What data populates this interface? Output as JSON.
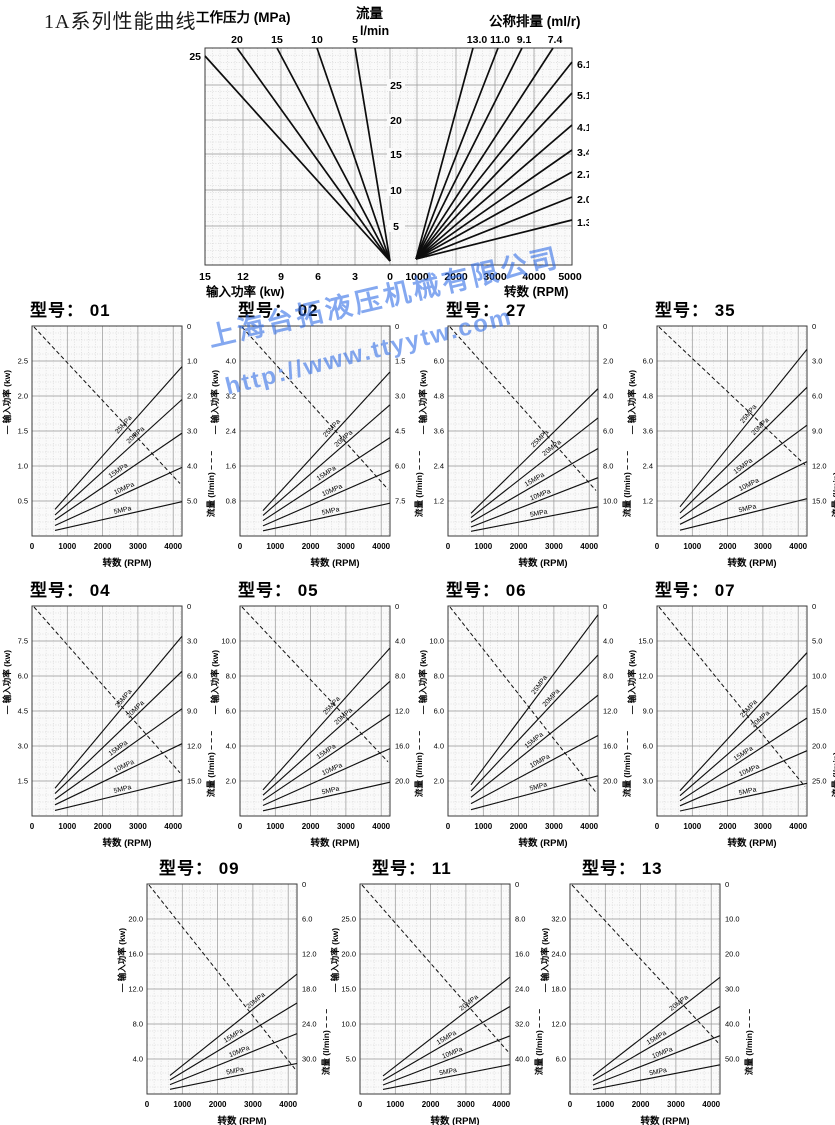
{
  "page_title": "1A系列性能曲线",
  "watermark": {
    "line1": "上海台拓液压机械有限公司",
    "line2": "http://www.ttyytw.com",
    "color": "#3272e0"
  },
  "main_chart": {
    "axis_title_pressure": "工作压力 (MPa)",
    "axis_title_flow": "流量",
    "axis_title_flow_unit": "l/min",
    "axis_title_displacement": "公称排量 (ml/r)",
    "pressure_top_ticks": [
      "20",
      "15",
      "10",
      "5"
    ],
    "pressure_left_tick": "25",
    "displacement_top_ticks": [
      "13.0",
      "11.0",
      "9.1",
      "7.4"
    ],
    "displacement_right_ticks": [
      "6.1",
      "5.1",
      "4.1",
      "3.4",
      "2.7",
      "2.0",
      "1.3"
    ],
    "flow_center_ticks": [
      "25",
      "20",
      "15",
      "10",
      "5"
    ],
    "power_bottom_ticks": [
      "15",
      "12",
      "9",
      "6",
      "3",
      "0"
    ],
    "rpm_bottom_ticks": [
      "1000",
      "2000",
      "3000",
      "4000",
      "5000"
    ],
    "caption_left": "输入功率 (kw)",
    "caption_right": "转数 (RPM)"
  },
  "small_chart_common": {
    "title_prefix": "型号：",
    "x_ticks": [
      "0",
      "1000",
      "2000",
      "3000",
      "4000"
    ],
    "x_caption": "转数 (RPM)",
    "y_left_label": "— 输入功率 (kw)",
    "y_right_label": "流量  (l/min)",
    "dashed_legend": "– – –"
  },
  "chart_data": {
    "main": {
      "type": "line",
      "title": "1A系列性能曲线",
      "left_half_x_axis": {
        "label": "输入功率 (kw)",
        "range": [
          15,
          0
        ]
      },
      "right_half_x_axis": {
        "label": "转数 (RPM)",
        "range": [
          0,
          5000
        ]
      },
      "center_y_axis": {
        "label": "流量 l/min",
        "range": [
          0,
          28
        ],
        "ticks": [
          25,
          20,
          15,
          10,
          5
        ]
      },
      "pressure_lines_MPa": [
        {
          "label": "25",
          "kw_at_28_lmin": 15.0,
          "kw_at_0_lmin": 0
        },
        {
          "label": "20",
          "kw_at_28_lmin": 12.3,
          "kw_at_0_lmin": 0
        },
        {
          "label": "15",
          "kw_at_28_lmin": 9.2,
          "kw_at_0_lmin": 0
        },
        {
          "label": "10",
          "kw_at_28_lmin": 6.1,
          "kw_at_0_lmin": 0
        },
        {
          "label": "5",
          "kw_at_28_lmin": 2.8,
          "kw_at_0_lmin": 0
        }
      ],
      "displacement_lines_ml_r": [
        {
          "label": "13.0",
          "lmin_per_1000rpm": 13.0
        },
        {
          "label": "11.0",
          "lmin_per_1000rpm": 11.0
        },
        {
          "label": "9.1",
          "lmin_per_1000rpm": 9.1
        },
        {
          "label": "7.4",
          "lmin_per_1000rpm": 7.4
        },
        {
          "label": "6.1",
          "lmin_per_1000rpm": 6.1
        },
        {
          "label": "5.1",
          "lmin_per_1000rpm": 5.1
        },
        {
          "label": "4.1",
          "lmin_per_1000rpm": 4.1
        },
        {
          "label": "3.4",
          "lmin_per_1000rpm": 3.4
        },
        {
          "label": "2.7",
          "lmin_per_1000rpm": 2.7
        },
        {
          "label": "2.0",
          "lmin_per_1000rpm": 2.0
        },
        {
          "label": "1.3",
          "lmin_per_1000rpm": 1.3
        }
      ]
    },
    "models": [
      {
        "model": "01",
        "type": "line",
        "x_axis": {
          "label": "转数 (RPM)",
          "range": [
            0,
            4250
          ],
          "ticks": [
            0,
            1000,
            2000,
            3000,
            4000
          ]
        },
        "left_ticks": [
          "0.5",
          "1.0",
          "1.5",
          "2.0",
          "2.5"
        ],
        "left_axis_max_kw": 3.0,
        "right_ticks": [
          "0",
          "1.0",
          "2.0",
          "3.0",
          "4.0",
          "5.0"
        ],
        "right_axis_max_lmin": 6.0,
        "solid_lines": [
          {
            "label": "25MPa",
            "kw_at_700rpm": 0.38,
            "kw_at_4100rpm": 2.42
          },
          {
            "label": "20MPa",
            "kw_at_700rpm": 0.3,
            "kw_at_4100rpm": 1.95
          },
          {
            "label": "15MPa",
            "kw_at_700rpm": 0.23,
            "kw_at_4100rpm": 1.47
          },
          {
            "label": "10MPa",
            "kw_at_700rpm": 0.15,
            "kw_at_4100rpm": 0.98
          },
          {
            "label": "5MPa",
            "kw_at_700rpm": 0.08,
            "kw_at_4100rpm": 0.49
          }
        ],
        "dashed_flow_line": {
          "lmin_at_0rpm": 0,
          "lmin_at_4100rpm": 4.5
        }
      },
      {
        "model": "02",
        "type": "line",
        "x_axis": {
          "label": "转数 (RPM)",
          "range": [
            0,
            4250
          ],
          "ticks": [
            0,
            1000,
            2000,
            3000,
            4000
          ]
        },
        "left_ticks": [
          "0.8",
          "1.6",
          "2.4",
          "3.2",
          "4.0"
        ],
        "left_axis_max_kw": 4.8,
        "right_ticks": [
          "0",
          "1.5",
          "3.0",
          "4.5",
          "6.0",
          "7.5"
        ],
        "right_axis_max_lmin": 9.0,
        "solid_lines": [
          {
            "label": "25MPa",
            "kw_at_700rpm": 0.58,
            "kw_at_4100rpm": 3.75
          },
          {
            "label": "20MPa",
            "kw_at_700rpm": 0.47,
            "kw_at_4100rpm": 3.0
          },
          {
            "label": "15MPa",
            "kw_at_700rpm": 0.35,
            "kw_at_4100rpm": 2.25
          },
          {
            "label": "10MPa",
            "kw_at_700rpm": 0.23,
            "kw_at_4100rpm": 1.5
          },
          {
            "label": "5MPa",
            "kw_at_700rpm": 0.12,
            "kw_at_4100rpm": 0.75
          }
        ],
        "dashed_flow_line": {
          "lmin_at_0rpm": 0,
          "lmin_at_4100rpm": 7.0
        }
      },
      {
        "model": "27",
        "type": "line",
        "x_axis": {
          "label": "转数 (RPM)",
          "range": [
            0,
            4250
          ],
          "ticks": [
            0,
            1000,
            2000,
            3000,
            4000
          ]
        },
        "left_ticks": [
          "1.2",
          "2.4",
          "3.6",
          "4.8",
          "6.0"
        ],
        "left_axis_max_kw": 7.2,
        "right_ticks": [
          "0",
          "2.0",
          "4.0",
          "6.0",
          "8.0",
          "10.0"
        ],
        "right_axis_max_lmin": 12.0,
        "solid_lines": [
          {
            "label": "25MPa",
            "kw_at_700rpm": 0.78,
            "kw_at_4100rpm": 5.05
          },
          {
            "label": "20MPa",
            "kw_at_700rpm": 0.63,
            "kw_at_4100rpm": 4.05
          },
          {
            "label": "15MPa",
            "kw_at_700rpm": 0.47,
            "kw_at_4100rpm": 3.0
          },
          {
            "label": "10MPa",
            "kw_at_700rpm": 0.31,
            "kw_at_4100rpm": 2.0
          },
          {
            "label": "5MPa",
            "kw_at_700rpm": 0.16,
            "kw_at_4100rpm": 1.0
          }
        ],
        "dashed_flow_line": {
          "lmin_at_0rpm": 0,
          "lmin_at_4100rpm": 9.4
        }
      },
      {
        "model": "35",
        "type": "line",
        "x_axis": {
          "label": "转数 (RPM)",
          "range": [
            0,
            4250
          ],
          "ticks": [
            0,
            1000,
            2000,
            3000,
            4000
          ]
        },
        "left_ticks": [
          "1.2",
          "2.4",
          "3.6",
          "4.8",
          "6.0"
        ],
        "left_axis_max_kw": 7.2,
        "right_ticks": [
          "0",
          "3.0",
          "6.0",
          "9.0",
          "12.0",
          "15.0"
        ],
        "right_axis_max_lmin": 18.0,
        "solid_lines": [
          {
            "label": "25MPa",
            "kw_at_700rpm": 1.0,
            "kw_at_4100rpm": 6.4
          },
          {
            "label": "20MPa",
            "kw_at_700rpm": 0.79,
            "kw_at_4100rpm": 5.1
          },
          {
            "label": "15MPa",
            "kw_at_700rpm": 0.59,
            "kw_at_4100rpm": 3.8
          },
          {
            "label": "10MPa",
            "kw_at_700rpm": 0.4,
            "kw_at_4100rpm": 2.55
          },
          {
            "label": "5MPa",
            "kw_at_700rpm": 0.2,
            "kw_at_4100rpm": 1.28
          }
        ],
        "dashed_flow_line": {
          "lmin_at_0rpm": 0,
          "lmin_at_4100rpm": 11.9
        }
      },
      {
        "model": "04",
        "type": "line",
        "x_axis": {
          "label": "转数 (RPM)",
          "range": [
            0,
            4250
          ],
          "ticks": [
            0,
            1000,
            2000,
            3000,
            4000
          ]
        },
        "left_ticks": [
          "1.5",
          "3.0",
          "4.5",
          "6.0",
          "7.5"
        ],
        "left_axis_max_kw": 9.0,
        "right_ticks": [
          "0",
          "3.0",
          "6.0",
          "9.0",
          "12.0",
          "15.0"
        ],
        "right_axis_max_lmin": 18.0,
        "solid_lines": [
          {
            "label": "25MPa",
            "kw_at_700rpm": 1.19,
            "kw_at_4100rpm": 7.7
          },
          {
            "label": "20MPa",
            "kw_at_700rpm": 0.96,
            "kw_at_4100rpm": 6.2
          },
          {
            "label": "15MPa",
            "kw_at_700rpm": 0.71,
            "kw_at_4100rpm": 4.6
          },
          {
            "label": "10MPa",
            "kw_at_700rpm": 0.48,
            "kw_at_4100rpm": 3.1
          },
          {
            "label": "5MPa",
            "kw_at_700rpm": 0.24,
            "kw_at_4100rpm": 1.55
          }
        ],
        "dashed_flow_line": {
          "lmin_at_0rpm": 0,
          "lmin_at_4100rpm": 14.3
        }
      },
      {
        "model": "05",
        "type": "line",
        "x_axis": {
          "label": "转数 (RPM)",
          "range": [
            0,
            4250
          ],
          "ticks": [
            0,
            1000,
            2000,
            3000,
            4000
          ]
        },
        "left_ticks": [
          "2.0",
          "4.0",
          "6.0",
          "8.0",
          "10.0"
        ],
        "left_axis_max_kw": 12.0,
        "right_ticks": [
          "0",
          "4.0",
          "8.0",
          "12.0",
          "16.0",
          "20.0"
        ],
        "right_axis_max_lmin": 24.0,
        "solid_lines": [
          {
            "label": "25MPa",
            "kw_at_700rpm": 1.49,
            "kw_at_4100rpm": 9.6
          },
          {
            "label": "20MPa",
            "kw_at_700rpm": 1.19,
            "kw_at_4100rpm": 7.7
          },
          {
            "label": "15MPa",
            "kw_at_700rpm": 0.9,
            "kw_at_4100rpm": 5.8
          },
          {
            "label": "10MPa",
            "kw_at_700rpm": 0.6,
            "kw_at_4100rpm": 3.85
          },
          {
            "label": "5MPa",
            "kw_at_700rpm": 0.3,
            "kw_at_4100rpm": 1.93
          }
        ],
        "dashed_flow_line": {
          "lmin_at_0rpm": 0,
          "lmin_at_4100rpm": 17.8
        }
      },
      {
        "model": "06",
        "type": "line",
        "x_axis": {
          "label": "转数 (RPM)",
          "range": [
            0,
            4250
          ],
          "ticks": [
            0,
            1000,
            2000,
            3000,
            4000
          ]
        },
        "left_ticks": [
          "2.0",
          "4.0",
          "6.0",
          "8.0",
          "10.0"
        ],
        "left_axis_max_kw": 12.0,
        "right_ticks": [
          "0",
          "4.0",
          "8.0",
          "12.0",
          "16.0",
          "20.0"
        ],
        "right_axis_max_lmin": 24.0,
        "solid_lines": [
          {
            "label": "25MPa",
            "kw_at_700rpm": 1.78,
            "kw_at_4100rpm": 11.5
          },
          {
            "label": "20MPa",
            "kw_at_700rpm": 1.43,
            "kw_at_4100rpm": 9.2
          },
          {
            "label": "15MPa",
            "kw_at_700rpm": 1.07,
            "kw_at_4100rpm": 6.9
          },
          {
            "label": "10MPa",
            "kw_at_700rpm": 0.71,
            "kw_at_4100rpm": 4.6
          },
          {
            "label": "5MPa",
            "kw_at_700rpm": 0.36,
            "kw_at_4100rpm": 2.3
          }
        ],
        "dashed_flow_line": {
          "lmin_at_0rpm": 0,
          "lmin_at_4100rpm": 21.3
        }
      },
      {
        "model": "07",
        "type": "line",
        "x_axis": {
          "label": "转数 (RPM)",
          "range": [
            0,
            4250
          ],
          "ticks": [
            0,
            1000,
            2000,
            3000,
            4000
          ]
        },
        "left_ticks": [
          "3.0",
          "6.0",
          "9.0",
          "12.0",
          "15.0"
        ],
        "left_axis_max_kw": 18.0,
        "right_ticks": [
          "0",
          "5.0",
          "10.0",
          "15.0",
          "20.0",
          "25.0"
        ],
        "right_axis_max_lmin": 30.0,
        "solid_lines": [
          {
            "label": "25MPa",
            "kw_at_700rpm": 2.17,
            "kw_at_4100rpm": 14.0
          },
          {
            "label": "20MPa",
            "kw_at_700rpm": 1.74,
            "kw_at_4100rpm": 11.2
          },
          {
            "label": "15MPa",
            "kw_at_700rpm": 1.3,
            "kw_at_4100rpm": 8.4
          },
          {
            "label": "10MPa",
            "kw_at_700rpm": 0.87,
            "kw_at_4100rpm": 5.6
          },
          {
            "label": "5MPa",
            "kw_at_700rpm": 0.43,
            "kw_at_4100rpm": 2.8
          }
        ],
        "dashed_flow_line": {
          "lmin_at_0rpm": 0,
          "lmin_at_4100rpm": 25.8
        }
      },
      {
        "model": "09",
        "type": "line",
        "x_axis": {
          "label": "转数 (RPM)",
          "range": [
            0,
            4250
          ],
          "ticks": [
            0,
            1000,
            2000,
            3000,
            4000
          ]
        },
        "left_ticks": [
          "4.0",
          "8.0",
          "12.0",
          "16.0",
          "20.0"
        ],
        "left_axis_max_kw": 24.0,
        "right_ticks": [
          "0",
          "6.0",
          "12.0",
          "18.0",
          "24.0",
          "30.0"
        ],
        "right_axis_max_lmin": 36.0,
        "solid_lines": [
          {
            "label": "20MPa",
            "kw_at_700rpm": 2.12,
            "kw_at_4100rpm": 13.7
          },
          {
            "label": "15MPa",
            "kw_at_700rpm": 1.61,
            "kw_at_4100rpm": 10.4
          },
          {
            "label": "10MPa",
            "kw_at_700rpm": 1.07,
            "kw_at_4100rpm": 6.9
          },
          {
            "label": "5MPa",
            "kw_at_700rpm": 0.54,
            "kw_at_4100rpm": 3.5
          }
        ],
        "dashed_flow_line": {
          "lmin_at_0rpm": 0,
          "lmin_at_4100rpm": 31.7
        }
      },
      {
        "model": "11",
        "type": "line",
        "x_axis": {
          "label": "转数 (RPM)",
          "range": [
            0,
            4250
          ],
          "ticks": [
            0,
            1000,
            2000,
            3000,
            4000
          ]
        },
        "left_ticks": [
          "5.0",
          "10.0",
          "15.0",
          "20.0",
          "25.0"
        ],
        "left_axis_max_kw": 30.0,
        "right_ticks": [
          "0",
          "8.0",
          "16.0",
          "24.0",
          "32.0",
          "40.0"
        ],
        "right_axis_max_lmin": 48.0,
        "solid_lines": [
          {
            "label": "20MPa",
            "kw_at_700rpm": 2.59,
            "kw_at_4100rpm": 16.7
          },
          {
            "label": "15MPa",
            "kw_at_700rpm": 1.94,
            "kw_at_4100rpm": 12.5
          },
          {
            "label": "10MPa",
            "kw_at_700rpm": 1.29,
            "kw_at_4100rpm": 8.3
          },
          {
            "label": "5MPa",
            "kw_at_700rpm": 0.65,
            "kw_at_4100rpm": 4.2
          }
        ],
        "dashed_flow_line": {
          "lmin_at_0rpm": 0,
          "lmin_at_4100rpm": 38.3
        }
      },
      {
        "model": "13",
        "type": "line",
        "x_axis": {
          "label": "转数 (RPM)",
          "range": [
            0,
            4250
          ],
          "ticks": [
            0,
            1000,
            2000,
            3000,
            4000
          ]
        },
        "left_ticks": [
          "6.0",
          "12.0",
          "18.0",
          "24.0",
          "32.0"
        ],
        "left_axis_max_kw": 36.0,
        "right_ticks": [
          "0",
          "10.0",
          "20.0",
          "30.0",
          "40.0",
          "50.0"
        ],
        "right_axis_max_lmin": 60.0,
        "solid_lines": [
          {
            "label": "20MPa",
            "kw_at_700rpm": 3.1,
            "kw_at_4100rpm": 20.0
          },
          {
            "label": "15MPa",
            "kw_at_700rpm": 2.33,
            "kw_at_4100rpm": 15.0
          },
          {
            "label": "10MPa",
            "kw_at_700rpm": 1.55,
            "kw_at_4100rpm": 10.0
          },
          {
            "label": "5MPa",
            "kw_at_700rpm": 0.78,
            "kw_at_4100rpm": 5.0
          }
        ],
        "dashed_flow_line": {
          "lmin_at_0rpm": 0,
          "lmin_at_4100rpm": 45.3
        }
      }
    ]
  }
}
